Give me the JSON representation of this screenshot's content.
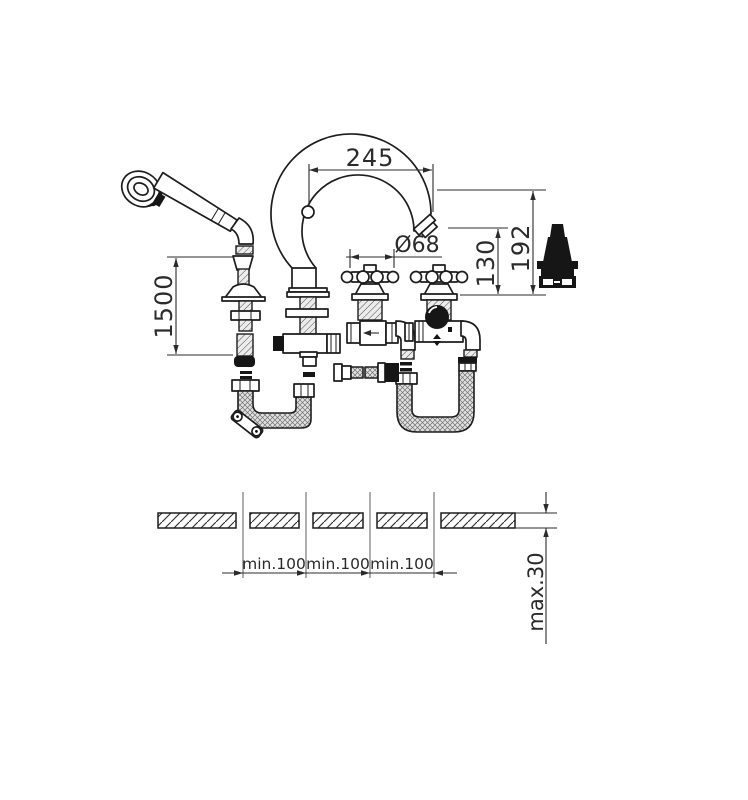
{
  "canvas": {
    "background": "#ffffff",
    "ink": "#1d1d1d"
  },
  "labels": {
    "spout_reach": "245",
    "total_height": "192",
    "outlet_height": "130",
    "handle_diameter": "Ø68",
    "hose_length": "1500",
    "pitch1": "min.100",
    "pitch2": "min.100",
    "pitch3": "min.100",
    "deck_thickness": "max.30"
  }
}
